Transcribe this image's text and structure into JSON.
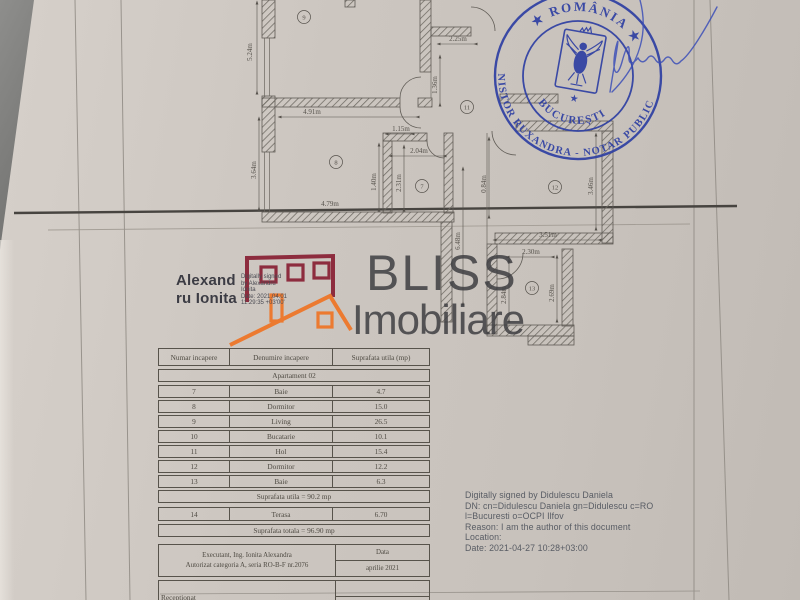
{
  "signature_stamp": {
    "name_line1": "Alexand",
    "name_line2": "ru Ionita",
    "detail_lines": [
      "Digitally signed",
      "by Alexandru",
      "Ionita",
      "Date: 2021.04.01",
      "11:29:35 +03'00'"
    ]
  },
  "watermark": {
    "line1": "BLISS",
    "line2": "Imobiliare"
  },
  "stamp": {
    "country": "★ ROMÂNIA ★",
    "city": "BUCUREȘTI",
    "notary": "NISTOR RUXANDRA - NOTAR PUBLIC",
    "star": "★",
    "color": "#2e3fa3"
  },
  "floor_plan": {
    "rooms": [
      "9",
      "11",
      "8",
      "7",
      "12",
      "13"
    ],
    "dims": [
      "5.24m",
      "2.25m",
      "1.36m",
      "4.91m",
      "1.15m",
      "2.04m",
      "1.40m",
      "2.31m",
      "3.64m",
      "4.79m",
      "0.84m",
      "6.48m",
      "3.51m",
      "3.46m",
      "2.30m",
      "2.84m",
      "2.69m"
    ]
  },
  "table": {
    "headers": [
      "Numar incapere",
      "Denumire incapere",
      "Suprafata utila (mp)"
    ],
    "apartment_label": "Apartament 02",
    "rows": [
      {
        "nr": "7",
        "name": "Baie",
        "area": "4.7"
      },
      {
        "nr": "8",
        "name": "Dormitor",
        "area": "15.0"
      },
      {
        "nr": "9",
        "name": "Living",
        "area": "26.5"
      },
      {
        "nr": "10",
        "name": "Bucatarie",
        "area": "10.1"
      },
      {
        "nr": "11",
        "name": "Hol",
        "area": "15.4"
      },
      {
        "nr": "12",
        "name": "Dormitor",
        "area": "12.2"
      },
      {
        "nr": "13",
        "name": "Baie",
        "area": "6.3"
      }
    ],
    "subtotal": "Suprafata utila = 90.2 mp",
    "terrace": {
      "nr": "14",
      "name": "Terasa",
      "area": "6.70"
    },
    "total": "Suprafata totala = 96.90 mp",
    "executant_line1": "Executant,  Ing. Ionita Alexandra",
    "executant_line2": "Autorizat categoria A, seria RO-B-F nr.2076",
    "date_label": "Data",
    "date_value": "aprilie 2021",
    "received_label": "Receptionat"
  },
  "digital_signature": {
    "lines": [
      "Digitally signed by Didulescu Daniela",
      "DN: cn=Didulescu Daniela gn=Didulescu c=RO",
      "l=Bucuresti o=OCPI Ilfov",
      "Reason: I am the author of this document",
      "Location:",
      "Date: 2021-04-27 10:28+03:00"
    ]
  }
}
